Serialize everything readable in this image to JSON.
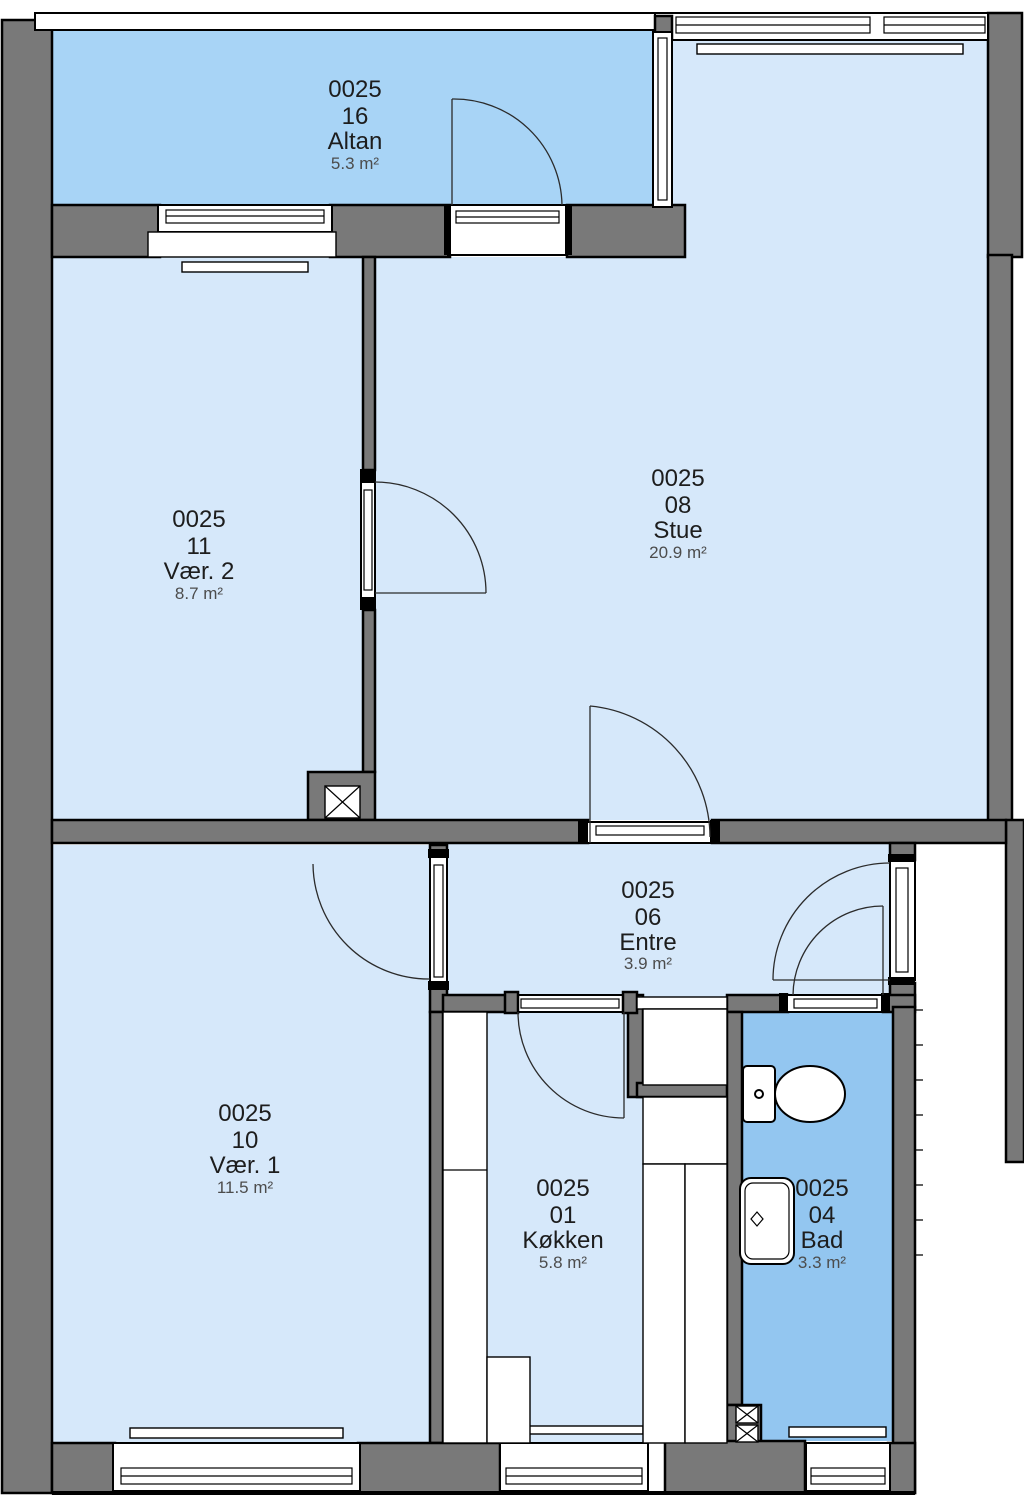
{
  "plan": {
    "unit_number": "0025",
    "type": "apartment-floor-plan"
  },
  "colors": {
    "wall": "#797979",
    "outline": "#000000",
    "floor": "#d6e8fa",
    "balcony_floor": "#a8d4f6",
    "bath_floor": "#93c6f0",
    "text": "#1d1d1d",
    "area_text": "#4c4c4c",
    "arc": "#2b2b2b",
    "background": "#ffffff"
  },
  "rooms": [
    {
      "key": "altan",
      "id": "0025",
      "number": "16",
      "name": "Altan",
      "area": "5.3 m²"
    },
    {
      "key": "vaer2",
      "id": "0025",
      "number": "11",
      "name": "Vær. 2",
      "area": "8.7 m²"
    },
    {
      "key": "stue",
      "id": "0025",
      "number": "08",
      "name": "Stue",
      "area": "20.9 m²"
    },
    {
      "key": "vaer1",
      "id": "0025",
      "number": "10",
      "name": "Vær. 1",
      "area": "11.5 m²"
    },
    {
      "key": "entre",
      "id": "0025",
      "number": "06",
      "name": "Entre",
      "area": "3.9 m²"
    },
    {
      "key": "koekken",
      "id": "0025",
      "number": "01",
      "name": "Køkken",
      "area": "5.8 m²"
    },
    {
      "key": "bad",
      "id": "0025",
      "number": "04",
      "name": "Bad",
      "area": "3.3 m²"
    }
  ]
}
